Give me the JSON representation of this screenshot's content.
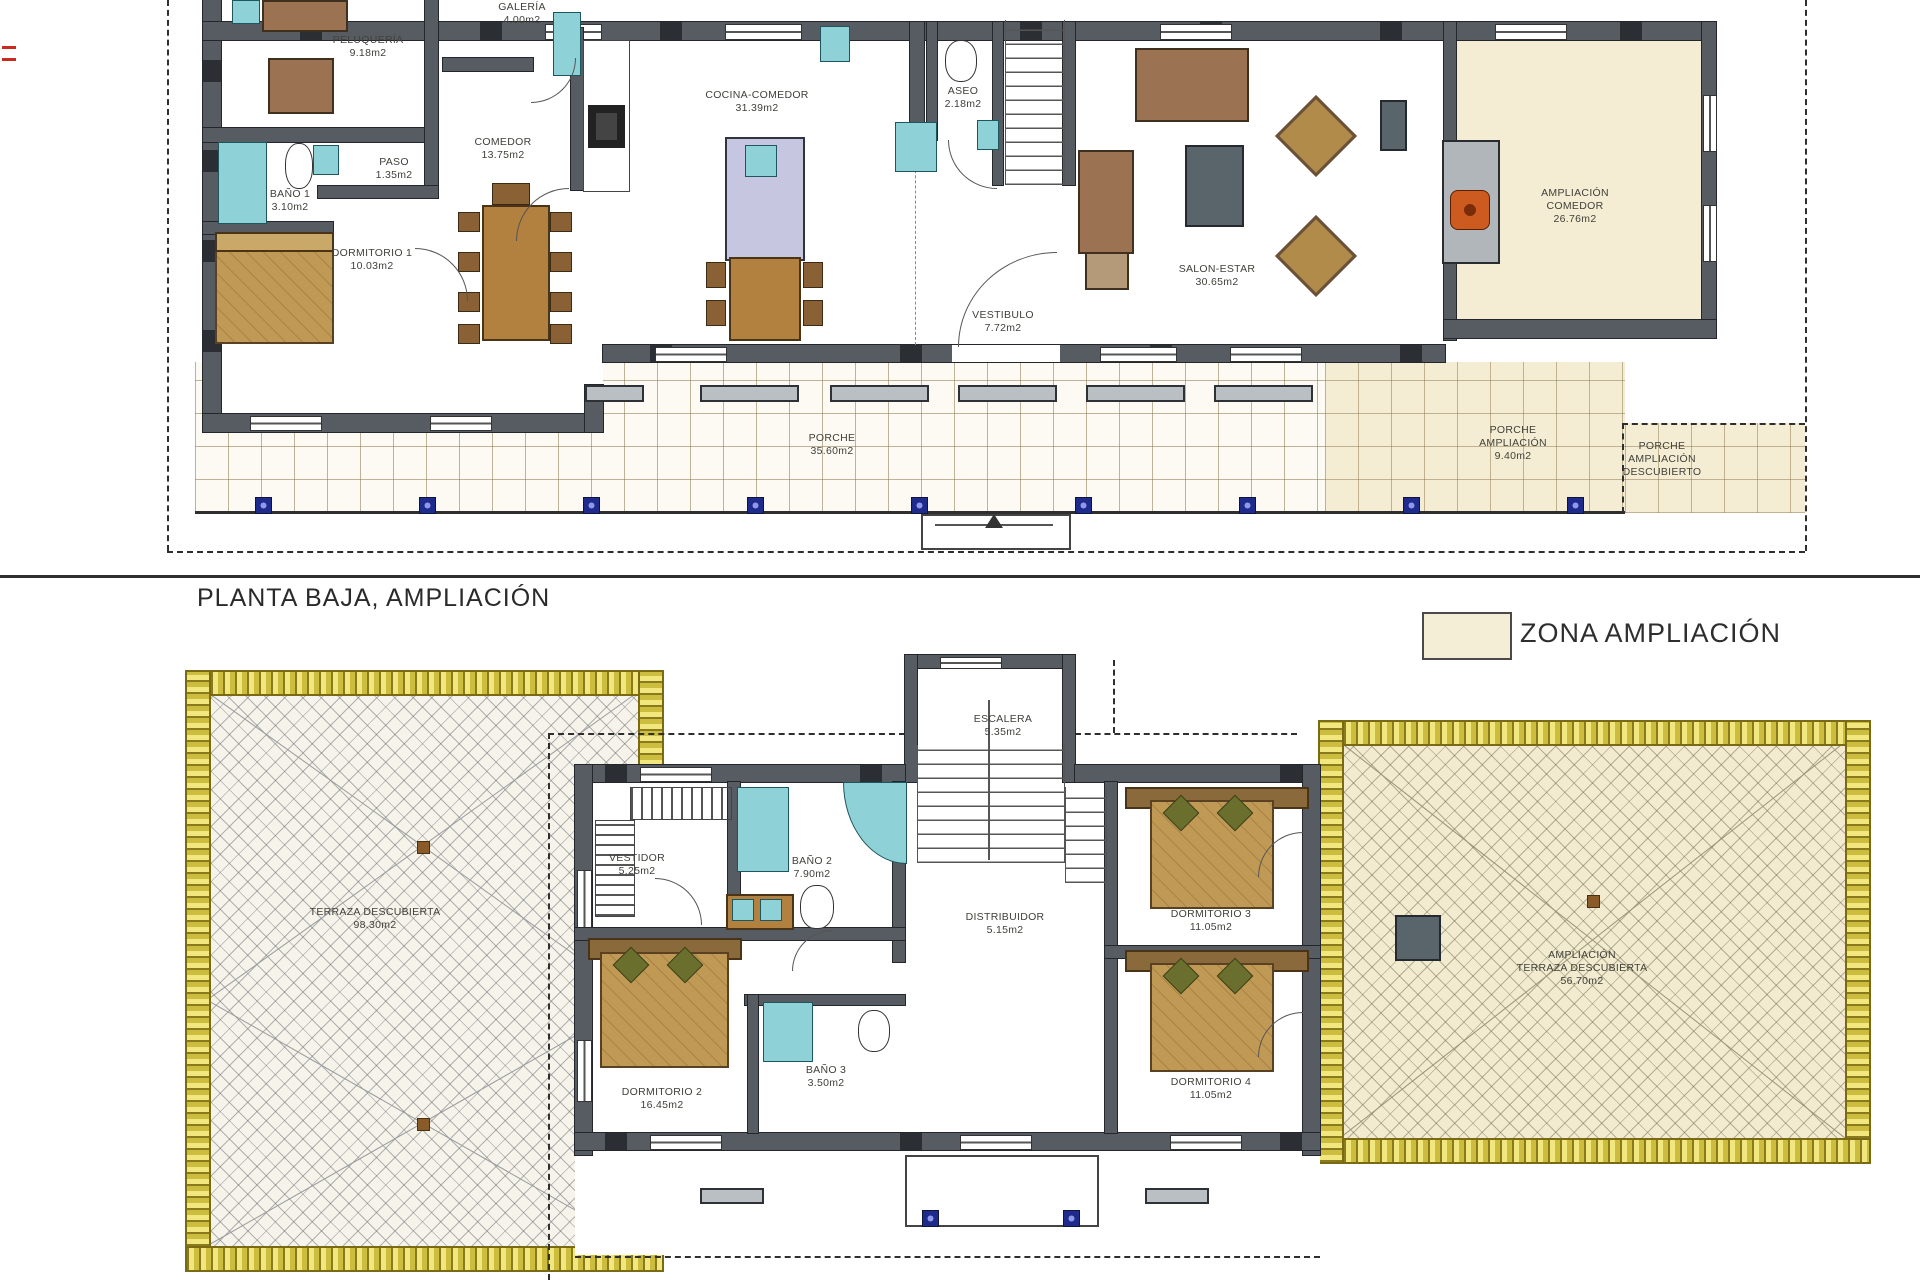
{
  "title": "PLANTA BAJA, AMPLIACIÓN",
  "legend": {
    "label": "ZONA AMPLIACIÓN"
  },
  "colors": {
    "wall": "#565c61",
    "ampliacion_beige": "#f4edd3",
    "yellow_border": "#e8dc66",
    "fixture_teal": "#8ed2d8",
    "furniture_wood": "#b3813f",
    "column_blue": "#1e2a8c",
    "fireplace_orange": "#cd5a1e"
  },
  "labels": [
    {
      "id": "galeria",
      "lines": [
        "GALERÍA",
        "4.00m2"
      ]
    },
    {
      "id": "peluqueria",
      "lines": [
        "PELUQUERÍA",
        "9.18m2"
      ]
    },
    {
      "id": "paso",
      "lines": [
        "PASO",
        "1.35m2"
      ]
    },
    {
      "id": "bano-1",
      "lines": [
        "BAÑO 1",
        "3.10m2"
      ]
    },
    {
      "id": "dormitorio-1",
      "lines": [
        "DORMITORIO 1",
        "10.03m2"
      ]
    },
    {
      "id": "comedor",
      "lines": [
        "COMEDOR",
        "13.75m2"
      ]
    },
    {
      "id": "cocina-comedor",
      "lines": [
        "COCINA-COMEDOR",
        "31.39m2"
      ]
    },
    {
      "id": "aseo",
      "lines": [
        "ASEO",
        "2.18m2"
      ]
    },
    {
      "id": "vestibulo",
      "lines": [
        "VESTIBULO",
        "7.72m2"
      ]
    },
    {
      "id": "salon-estar",
      "lines": [
        "SALON-ESTAR",
        "30.65m2"
      ]
    },
    {
      "id": "ampliacion-comedor",
      "lines": [
        "AMPLIACIÓN",
        "COMEDOR",
        "26.76m2"
      ]
    },
    {
      "id": "porche",
      "lines": [
        "PORCHE",
        "35.60m2"
      ]
    },
    {
      "id": "porche-ampliacion",
      "lines": [
        "PORCHE",
        "AMPLIACIÓN",
        "9.40m2"
      ]
    },
    {
      "id": "porche-amp-descubierto",
      "lines": [
        "PORCHE",
        "AMPLIACIÓN",
        "DESCUBIERTO"
      ]
    },
    {
      "id": "escalera",
      "lines": [
        "ESCALERA",
        "5.35m2"
      ]
    },
    {
      "id": "vestidor",
      "lines": [
        "VESTIDOR",
        "5.25m2"
      ]
    },
    {
      "id": "bano-2",
      "lines": [
        "BAÑO 2",
        "7.90m2"
      ]
    },
    {
      "id": "distribuidor",
      "lines": [
        "DISTRIBUIDOR",
        "5.15m2"
      ]
    },
    {
      "id": "dormitorio-3",
      "lines": [
        "DORMITORIO 3",
        "11.05m2"
      ]
    },
    {
      "id": "dormitorio-2",
      "lines": [
        "DORMITORIO 2",
        "16.45m2"
      ]
    },
    {
      "id": "bano-3",
      "lines": [
        "BAÑO 3",
        "3.50m2"
      ]
    },
    {
      "id": "dormitorio-4",
      "lines": [
        "DORMITORIO 4",
        "11.05m2"
      ]
    },
    {
      "id": "terraza-descubierta",
      "lines": [
        "TERRAZA DESCUBIERTA",
        "98.30m2"
      ]
    },
    {
      "id": "ampliacion-terraza",
      "lines": [
        "AMPLIACIÓN",
        "TERRAZA DESCUBIERTA",
        "56.70m2"
      ]
    }
  ]
}
